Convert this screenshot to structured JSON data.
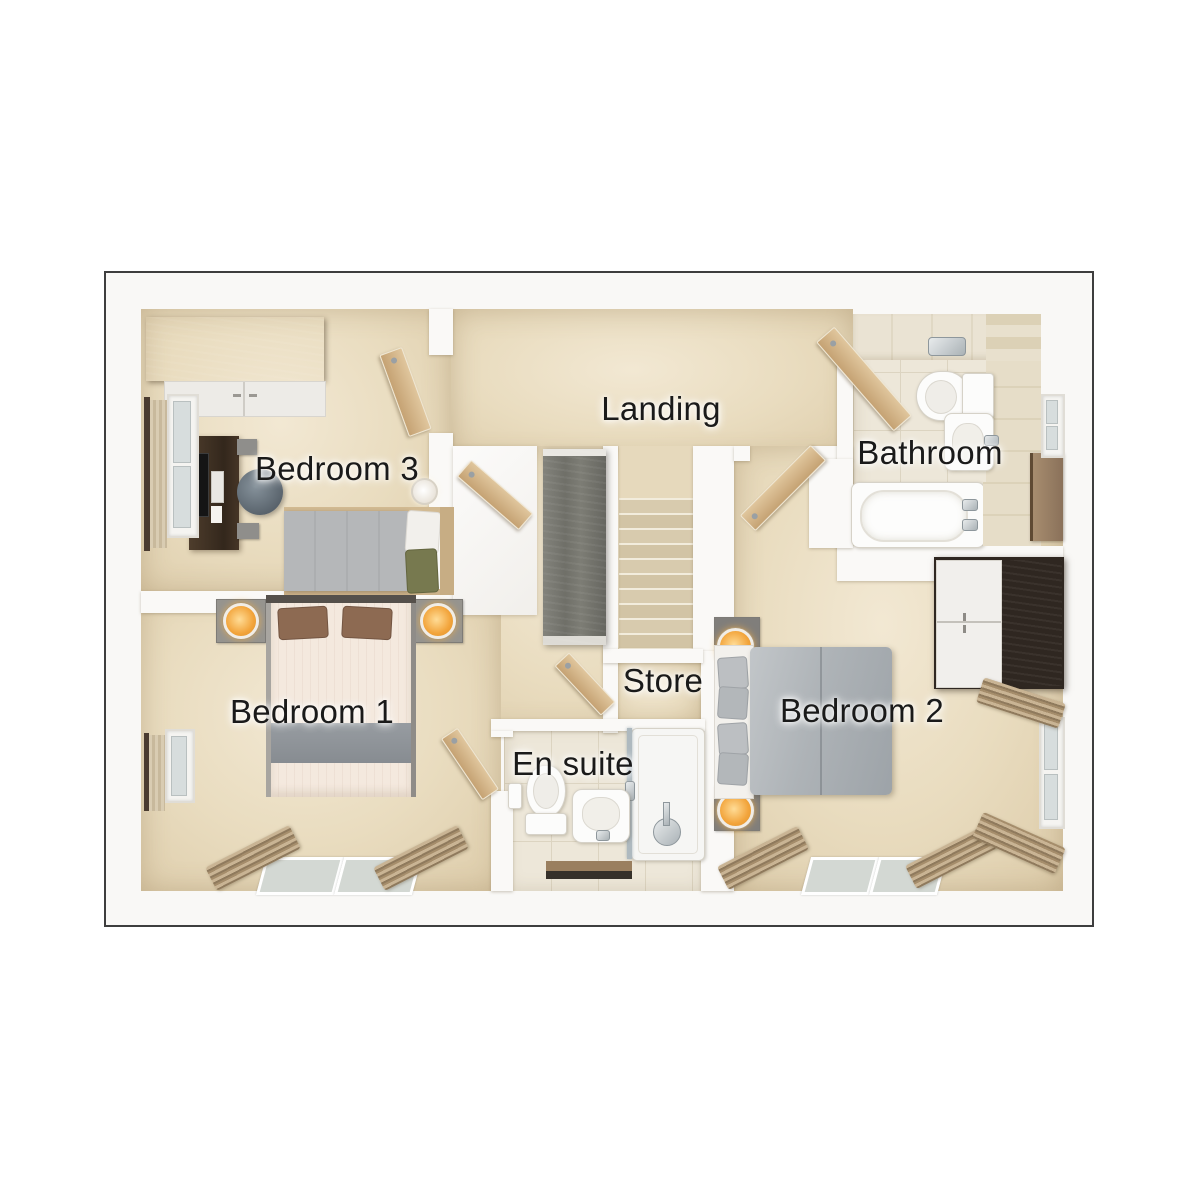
{
  "rooms": {
    "bedroom3": {
      "label": "Bedroom 3"
    },
    "landing": {
      "label": "Landing"
    },
    "bathroom": {
      "label": "Bathroom"
    },
    "bedroom1": {
      "label": "Bedroom 1"
    },
    "store": {
      "label": "Store"
    },
    "ensuite": {
      "label": "En suite"
    },
    "bedroom2": {
      "label": "Bedroom 2"
    }
  },
  "style": {
    "background": "#ffffff",
    "plan_border": "#3e3e3e",
    "wall": "#faf9f7",
    "carpet": "#e9dcbf",
    "tile": "#ede7d9",
    "door_wood": "#cba87a",
    "dark_wood": "#3a2e24",
    "cabinet_wood": "#73736c",
    "label_color": "#1a1a1a",
    "lamp_glow": "#f2a43b",
    "duvet_gray": "#aeb3b7",
    "duvet_cream": "#f4e9de",
    "pillow_green": "#77794f",
    "pillow_brown": "#8d6a52"
  }
}
